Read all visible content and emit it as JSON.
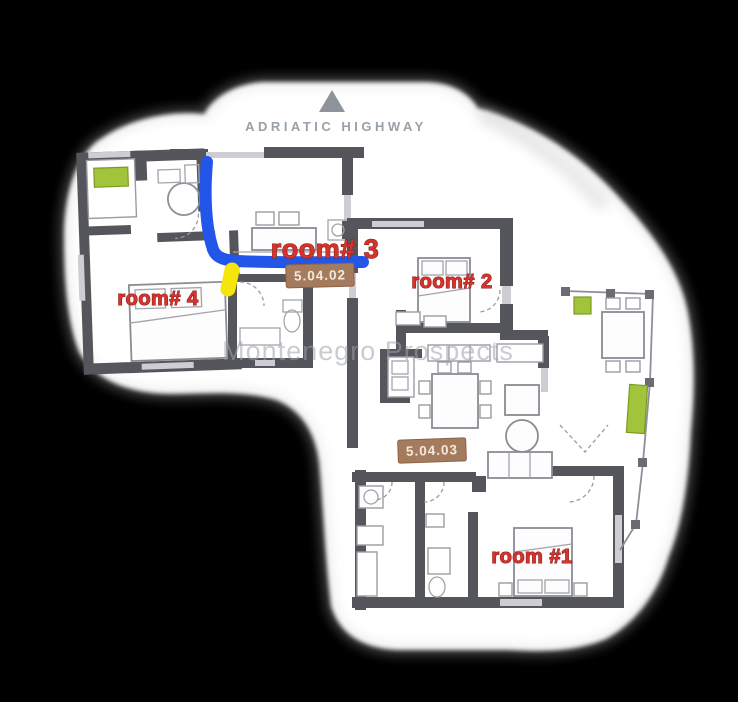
{
  "scene": {
    "type": "apartment-floor-plan",
    "map_label": "ADRIATIC HIGHWAY",
    "watermark": "Montenegro Prospects"
  },
  "rooms": [
    {
      "id": "room-3",
      "label": "room# 3"
    },
    {
      "id": "room-4",
      "label": "room# 4"
    },
    {
      "id": "room-2",
      "label": "room# 2"
    },
    {
      "id": "room-1",
      "label": "room #1"
    }
  ],
  "unit_badges": [
    {
      "id": "unit-5-04-02",
      "label": "5.04.02"
    },
    {
      "id": "unit-5-04-03",
      "label": "5.04.03"
    }
  ],
  "annotations": {
    "route_description": "blue path from top wall of room 3 to hallway",
    "marker_description": "yellow marker at hallway door below room 3"
  },
  "colors": {
    "background": "#000000",
    "plan_white": "#ffffff",
    "room_label_red": "#d5332c",
    "badge_brown": "#a57b5d",
    "badge_text": "#f3e9de",
    "route_blue": "#2256e8",
    "marker_yellow": "#f6e50a",
    "greenery": "#a2c43a",
    "wall_dark": "#55555c",
    "highway_text": "#9aa0a9",
    "watermark_gray": "#9da3ad"
  }
}
